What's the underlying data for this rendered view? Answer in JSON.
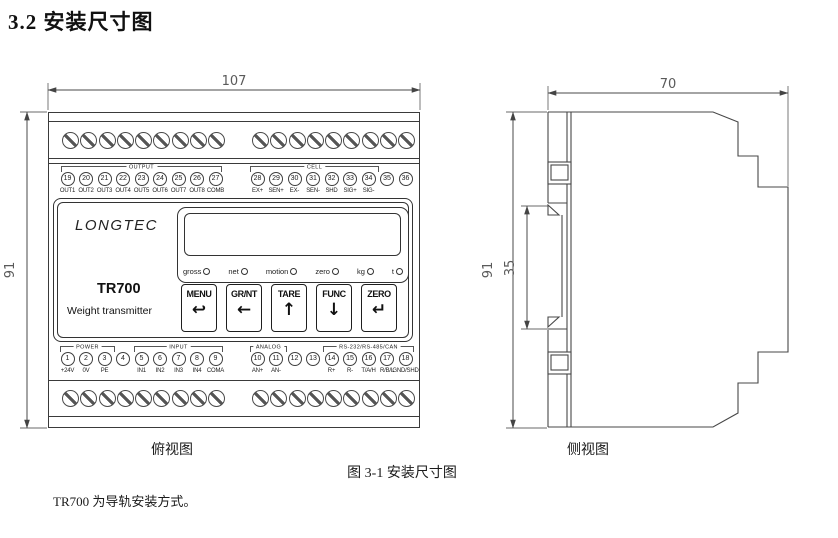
{
  "page": {
    "heading": "3.2 安装尺寸图",
    "figure_caption": "图 3-1 安装尺寸图",
    "note": "TR700 为导轨安装方式。"
  },
  "colors": {
    "line": "#4a4a4a",
    "text": "#111111"
  },
  "top_view": {
    "caption": "俯视图",
    "dim_width": "107",
    "dim_height": "91"
  },
  "side_view": {
    "caption": "侧视图",
    "dim_width": "70",
    "dim_height": "91",
    "dim_rail": "35"
  },
  "device": {
    "brand": "LONGTEC",
    "model": "TR700",
    "subtitle": "Weight transmitter",
    "indicators": [
      {
        "label": "gross"
      },
      {
        "label": "net"
      },
      {
        "label": "motion"
      },
      {
        "label": "zero"
      },
      {
        "label": "kg"
      },
      {
        "label": "t"
      }
    ],
    "buttons": [
      {
        "label": "MENU",
        "arrow": "↩"
      },
      {
        "label": "GR/NT",
        "arrow": "←"
      },
      {
        "label": "TARE",
        "arrow": "↑"
      },
      {
        "label": "FUNC",
        "arrow": "↓"
      },
      {
        "label": "ZERO",
        "arrow": "↵"
      }
    ],
    "top_terminals": {
      "left_group_label": "OUTPUT",
      "right_group_label": "CELL",
      "left": [
        {
          "num": "19",
          "label": "OUT1"
        },
        {
          "num": "20",
          "label": "OUT2"
        },
        {
          "num": "21",
          "label": "OUT3"
        },
        {
          "num": "22",
          "label": "OUT4"
        },
        {
          "num": "23",
          "label": "OUT5"
        },
        {
          "num": "24",
          "label": "OUT6"
        },
        {
          "num": "25",
          "label": "OUT7"
        },
        {
          "num": "26",
          "label": "OUT8"
        },
        {
          "num": "27",
          "label": "COMB"
        }
      ],
      "right": [
        {
          "num": "28",
          "label": "EX+"
        },
        {
          "num": "29",
          "label": "SEN+"
        },
        {
          "num": "30",
          "label": "EX-"
        },
        {
          "num": "31",
          "label": "SEN-"
        },
        {
          "num": "32",
          "label": "SHD"
        },
        {
          "num": "33",
          "label": "SIG+"
        },
        {
          "num": "34",
          "label": "SIG-"
        },
        {
          "num": "35",
          "label": ""
        },
        {
          "num": "36",
          "label": ""
        }
      ]
    },
    "bottom_terminals": {
      "group_power": "POWER",
      "group_input": "INPUT",
      "group_analog": "ANALOG",
      "group_comm": "RS-232/RS-485/CAN",
      "left": [
        {
          "num": "1",
          "label": "+24V"
        },
        {
          "num": "2",
          "label": "0V"
        },
        {
          "num": "3",
          "label": "PE"
        },
        {
          "num": "4",
          "label": ""
        },
        {
          "num": "5",
          "label": "IN1"
        },
        {
          "num": "6",
          "label": "IN2"
        },
        {
          "num": "7",
          "label": "IN3"
        },
        {
          "num": "8",
          "label": "IN4"
        },
        {
          "num": "9",
          "label": "COMA"
        }
      ],
      "right": [
        {
          "num": "10",
          "label": "AN+"
        },
        {
          "num": "11",
          "label": "AN-"
        },
        {
          "num": "12",
          "label": ""
        },
        {
          "num": "13",
          "label": ""
        },
        {
          "num": "14",
          "label": "R+"
        },
        {
          "num": "15",
          "label": "R-"
        },
        {
          "num": "16",
          "label": "T/A/H"
        },
        {
          "num": "17",
          "label": "R/B/L"
        },
        {
          "num": "18",
          "label": "GND/SHD"
        }
      ]
    }
  }
}
